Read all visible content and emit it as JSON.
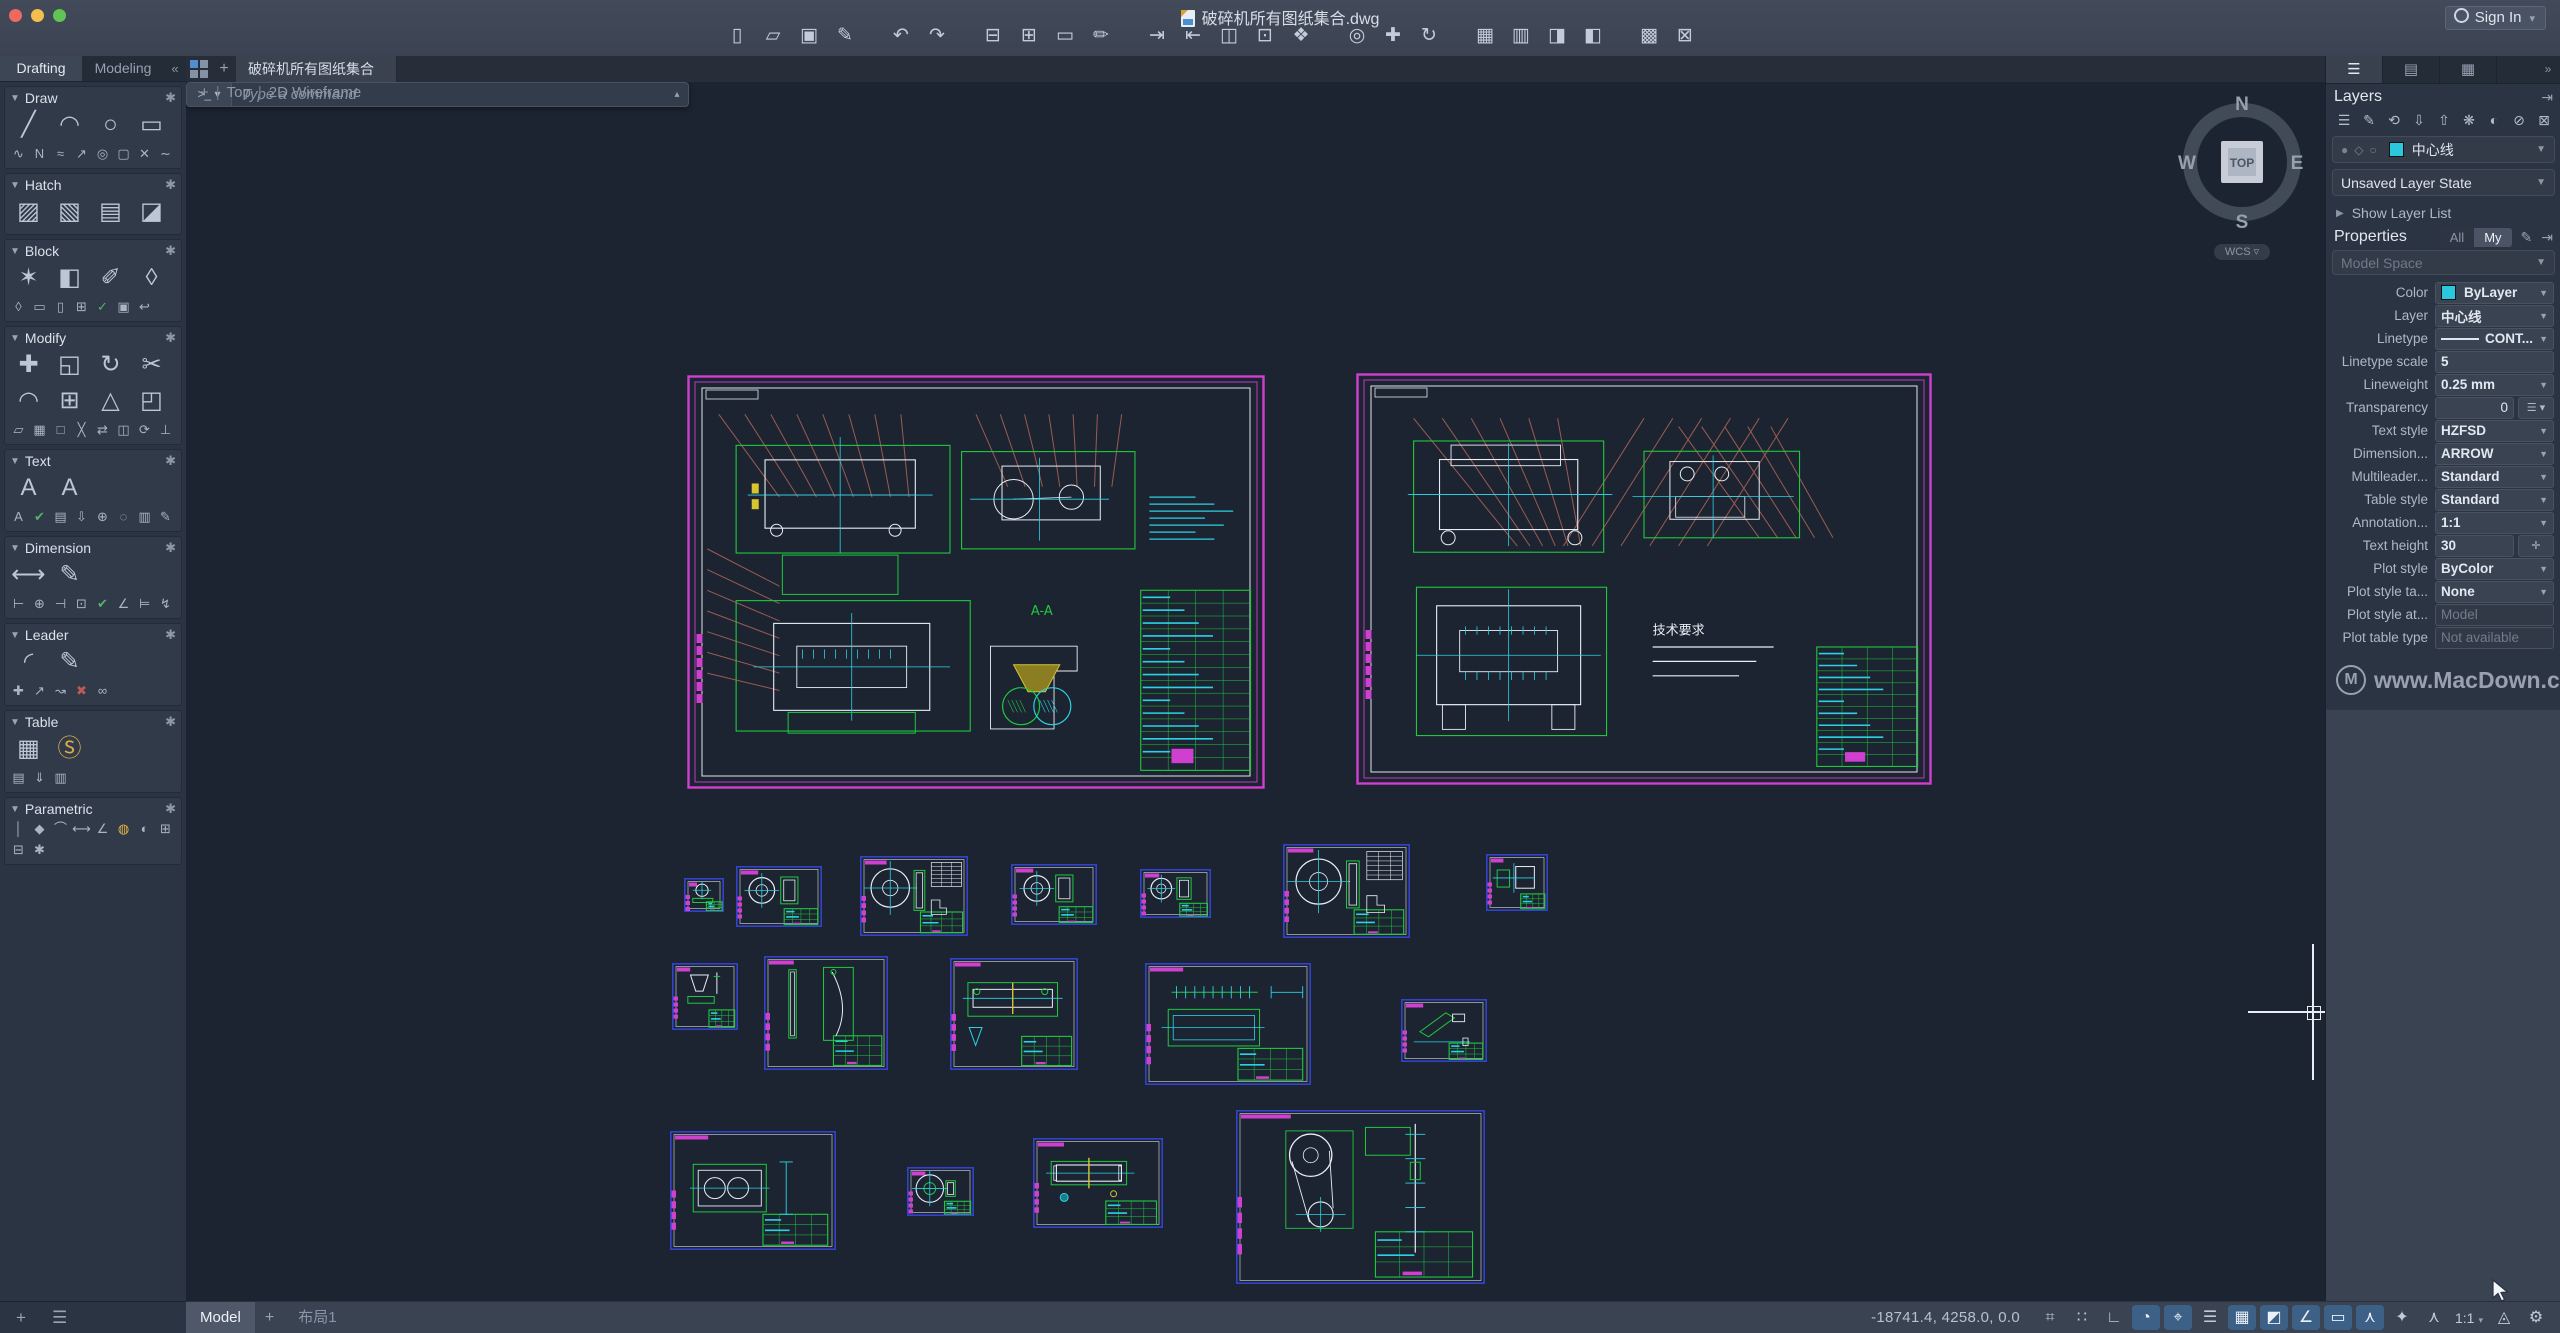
{
  "titlebar": {
    "title": "破碎机所有图纸集合.dwg",
    "sign_in": "Sign In",
    "toolbar_groups": [
      {
        "icons": [
          {
            "n": "new-file",
            "g": "▯"
          },
          {
            "n": "open-file",
            "g": "▱"
          },
          {
            "n": "save",
            "g": "▣"
          },
          {
            "n": "save-as",
            "g": "✎"
          }
        ]
      },
      {
        "icons": [
          {
            "n": "undo",
            "g": "↶"
          },
          {
            "n": "redo",
            "g": "↷"
          }
        ]
      },
      {
        "icons": [
          {
            "n": "print",
            "g": "⊟"
          },
          {
            "n": "batch-plot",
            "g": "⊞"
          },
          {
            "n": "page-setup",
            "g": "▭"
          },
          {
            "n": "plot-style",
            "g": "✏"
          }
        ]
      },
      {
        "icons": [
          {
            "n": "import",
            "g": "⇥"
          },
          {
            "n": "export",
            "g": "⇤"
          },
          {
            "n": "dwg-compare",
            "g": "◫"
          },
          {
            "n": "etransmit",
            "g": "⊡"
          },
          {
            "n": "reference",
            "g": "❖"
          }
        ]
      },
      {
        "icons": [
          {
            "n": "zoom",
            "g": "◎"
          },
          {
            "n": "pan",
            "g": "✚"
          },
          {
            "n": "orbit",
            "g": "↻"
          }
        ]
      },
      {
        "icons": [
          {
            "n": "tool-sets",
            "g": "▦"
          },
          {
            "n": "reference-manager",
            "g": "▥"
          },
          {
            "n": "design-center",
            "g": "◨"
          },
          {
            "n": "content-palette",
            "g": "◧"
          }
        ]
      },
      {
        "icons": [
          {
            "n": "layer-translator",
            "g": "▩"
          },
          {
            "n": "purge",
            "g": "⊠"
          }
        ]
      }
    ]
  },
  "left_palette": {
    "tabs": [
      {
        "label": "Drafting",
        "active": true
      },
      {
        "label": "Modeling",
        "active": false
      }
    ],
    "collapse": "«",
    "sections": [
      {
        "name": "Draw",
        "big": [
          {
            "n": "line",
            "g": "╱"
          },
          {
            "n": "arc",
            "g": "◠"
          },
          {
            "n": "circle",
            "g": "○"
          },
          {
            "n": "rectangle",
            "g": "▭"
          }
        ],
        "small": [
          {
            "n": "spline",
            "g": "∿"
          },
          {
            "n": "polyline",
            "g": "N"
          },
          {
            "n": "parallel",
            "g": "≈"
          },
          {
            "n": "ray",
            "g": "↗"
          },
          {
            "n": "ellipse",
            "g": "◎"
          },
          {
            "n": "polygon",
            "g": "▢"
          },
          {
            "n": "point",
            "g": "✕"
          },
          {
            "n": "revcloud",
            "g": "∼"
          }
        ]
      },
      {
        "name": "Hatch",
        "big": [
          {
            "n": "hatch",
            "g": "▨"
          },
          {
            "n": "hatch-edit",
            "g": "▧"
          },
          {
            "n": "gradient",
            "g": "▤"
          },
          {
            "n": "boundary",
            "g": "◪"
          }
        ],
        "small": []
      },
      {
        "name": "Block",
        "big": [
          {
            "n": "insert-block",
            "g": "✶"
          },
          {
            "n": "create-block",
            "g": "◧"
          },
          {
            "n": "edit-block",
            "g": "✐"
          },
          {
            "n": "define-attribute",
            "g": "◊"
          }
        ],
        "small": [
          {
            "n": "attribute-tag",
            "g": "◊"
          },
          {
            "n": "write-block",
            "g": "▭"
          },
          {
            "n": "save-block",
            "g": "▯"
          },
          {
            "n": "add-block",
            "g": "⊞"
          },
          {
            "n": "sync-attributes",
            "g": "✓"
          },
          {
            "n": "block-settings",
            "g": "▣"
          },
          {
            "n": "reset-block",
            "g": "↩"
          }
        ]
      },
      {
        "name": "Modify",
        "big": [
          {
            "n": "move",
            "g": "✚"
          },
          {
            "n": "copy",
            "g": "◱"
          },
          {
            "n": "rotate",
            "g": "↻"
          },
          {
            "n": "trim",
            "g": "✂"
          },
          {
            "n": "fillet",
            "g": "◠"
          },
          {
            "n": "array",
            "g": "⊞"
          },
          {
            "n": "mirror",
            "g": "△"
          },
          {
            "n": "stretch",
            "g": "◰"
          }
        ],
        "small": [
          {
            "n": "offset",
            "g": "▱"
          },
          {
            "n": "explode",
            "g": "▦"
          },
          {
            "n": "scale",
            "g": "□"
          },
          {
            "n": "break",
            "g": "╳"
          },
          {
            "n": "join",
            "g": "⇄"
          },
          {
            "n": "align",
            "g": "◫"
          },
          {
            "n": "update",
            "g": "⟳"
          },
          {
            "n": "erase",
            "g": "⊥"
          }
        ]
      },
      {
        "name": "Text",
        "big": [
          {
            "n": "multiline-text",
            "g": "A"
          },
          {
            "n": "edit-text",
            "g": "A"
          }
        ],
        "small": [
          {
            "n": "single-line-text",
            "g": "A"
          },
          {
            "n": "spell-check",
            "g": "✔"
          },
          {
            "n": "text-columns",
            "g": "▤"
          },
          {
            "n": "pdf-text",
            "g": "⇩"
          },
          {
            "n": "field",
            "g": "⊕"
          },
          {
            "n": "find-text",
            "g": "◌"
          },
          {
            "n": "text-style",
            "g": "▥"
          },
          {
            "n": "pdf-import",
            "g": "✎"
          }
        ]
      },
      {
        "name": "Dimension",
        "big": [
          {
            "n": "dimension",
            "g": "⟷"
          },
          {
            "n": "edit-dimension",
            "g": "✎"
          }
        ],
        "small": [
          {
            "n": "linear-dim",
            "g": "⊢"
          },
          {
            "n": "diameter-dim",
            "g": "⊕"
          },
          {
            "n": "baseline-dim",
            "g": "⊣"
          },
          {
            "n": "ordinate-dim",
            "g": "⊡"
          },
          {
            "n": "check-dim",
            "g": "✔"
          },
          {
            "n": "angular-dim",
            "g": "∠"
          },
          {
            "n": "continue-dim",
            "g": "⊨"
          },
          {
            "n": "jogged-dim",
            "g": "↯"
          }
        ]
      },
      {
        "name": "Leader",
        "big": [
          {
            "n": "multileader",
            "g": "◜"
          },
          {
            "n": "edit-leader",
            "g": "✎"
          }
        ],
        "small": [
          {
            "n": "add-leader",
            "g": "✚"
          },
          {
            "n": "align-leaders",
            "g": "↗"
          },
          {
            "n": "collect-leaders",
            "g": "↝"
          },
          {
            "n": "remove-leader",
            "g": "✖"
          },
          {
            "n": "merge-leaders",
            "g": "∞"
          }
        ]
      },
      {
        "name": "Table",
        "big": [
          {
            "n": "table",
            "g": "▦"
          },
          {
            "n": "data-link",
            "g": "Ⓢ"
          }
        ],
        "small": [
          {
            "n": "table-style",
            "g": "▤"
          },
          {
            "n": "export-table",
            "g": "⇓"
          },
          {
            "n": "update-table",
            "g": "▥"
          }
        ]
      },
      {
        "name": "Parametric",
        "big": [],
        "small": [
          {
            "n": "vertical-constraint",
            "g": "│"
          },
          {
            "n": "coincident-constraint",
            "g": "◆"
          },
          {
            "n": "tangent-constraint",
            "g": "⌒"
          },
          {
            "n": "dimensional-constraint",
            "g": "⟷"
          },
          {
            "n": "angle-constraint",
            "g": "∠"
          },
          {
            "n": "lock-constraint",
            "g": "◍"
          },
          {
            "n": "radius-constraint",
            "g": "◐"
          },
          {
            "n": "show-constraints",
            "g": "⊞"
          },
          {
            "n": "hide-constraints",
            "g": "⊟"
          },
          {
            "n": "constraint-settings",
            "g": "✱"
          }
        ]
      }
    ],
    "footer": [
      {
        "n": "add-view",
        "g": "+"
      },
      {
        "n": "view-list",
        "g": "☰"
      }
    ]
  },
  "doc_tabs": {
    "add": "+",
    "tabs": [
      {
        "label": "破碎机所有图纸集合",
        "active": true
      }
    ]
  },
  "viewport": {
    "add": "+",
    "view": "Top",
    "style": "2D Wireframe"
  },
  "compass": {
    "north": "N",
    "east": "E",
    "south": "S",
    "west": "W",
    "face": "TOP",
    "wcs": "WCS ▿"
  },
  "command": {
    "prompt": ">_ ▾",
    "placeholder": "Type a command",
    "expand": "▴"
  },
  "sidebar": {
    "tabs": [
      {
        "n": "tab-layers",
        "g": "☰",
        "active": true
      },
      {
        "n": "tab-references",
        "g": "▤",
        "active": false
      },
      {
        "n": "tab-sheets",
        "g": "▦",
        "active": false
      }
    ],
    "more": "»",
    "layers": {
      "title": "Layers",
      "autohide": "⇥",
      "tools": [
        {
          "n": "new-layer",
          "g": "☰"
        },
        {
          "n": "edit-layer",
          "g": "✎"
        },
        {
          "n": "layer-previous",
          "g": "⟲"
        },
        {
          "n": "isolate-layer",
          "g": "⇩"
        },
        {
          "n": "unisolate-layer",
          "g": "⇧"
        },
        {
          "n": "freeze-layer",
          "g": "❋"
        },
        {
          "n": "layer-off",
          "g": "◐"
        },
        {
          "n": "lock-layer",
          "g": "⊘"
        },
        {
          "n": "unlock-layer",
          "g": "⊠"
        }
      ],
      "current_layer": "中心线",
      "current_color": "#2bc7dc",
      "state": "Unsaved Layer State",
      "show_list": "Show Layer List"
    },
    "properties": {
      "title": "Properties",
      "filter_all": "All",
      "filter_my": "My",
      "edit_icon": "✎",
      "autohide": "⇥",
      "space": "Model Space",
      "rows": [
        {
          "label": "Color",
          "value": "ByLayer",
          "type": "color",
          "swatch": "#2bc7dc"
        },
        {
          "label": "Layer",
          "value": "中心线",
          "type": "select"
        },
        {
          "label": "Linetype",
          "value": "CONT...",
          "type": "linetype"
        },
        {
          "label": "Linetype scale",
          "value": "5",
          "type": "input"
        },
        {
          "label": "Lineweight",
          "value": "0.25 mm",
          "type": "select"
        },
        {
          "label": "Transparency",
          "value": "0",
          "type": "transparency"
        },
        {
          "label": "Text style",
          "value": "HZFSD",
          "type": "select"
        },
        {
          "label": "Dimension...",
          "value": "ARROW",
          "type": "select"
        },
        {
          "label": "Multileader...",
          "value": "Standard",
          "type": "select"
        },
        {
          "label": "Table style",
          "value": "Standard",
          "type": "select"
        },
        {
          "label": "Annotation...",
          "value": "1:1",
          "type": "select"
        },
        {
          "label": "Text height",
          "value": "30",
          "type": "textheight"
        },
        {
          "label": "Plot style",
          "value": "ByColor",
          "type": "select"
        },
        {
          "label": "Plot style ta...",
          "value": "None",
          "type": "select"
        },
        {
          "label": "Plot style at...",
          "value": "Model",
          "type": "readonly"
        },
        {
          "label": "Plot table type",
          "value": "Not available",
          "type": "readonly"
        }
      ]
    },
    "watermark": {
      "badge": "M",
      "text": "www.MacDown.com"
    }
  },
  "statusbar": {
    "model_tab": "Model",
    "add": "+",
    "layout_tab": "布局1",
    "coords": "-18741.4, 4258.0, 0.0",
    "icons": [
      {
        "n": "grid-mode",
        "g": "⌗",
        "on": false
      },
      {
        "n": "snap-mode",
        "g": "∷",
        "on": false
      },
      {
        "n": "ortho-mode",
        "g": "∟",
        "on": false
      },
      {
        "n": "polar-tracking",
        "g": "◔",
        "on": true
      },
      {
        "n": "dynamic-input",
        "g": "⌖",
        "on": true
      },
      {
        "n": "lineweight-display",
        "g": "☰",
        "on": false
      },
      {
        "n": "transparency-toggle",
        "g": "▦",
        "on": true
      },
      {
        "n": "selection-cycling",
        "g": "◩",
        "on": true
      },
      {
        "n": "object-snap",
        "g": "∠",
        "on": true
      },
      {
        "n": "snap-tracking",
        "g": "▭",
        "on": true
      },
      {
        "n": "object-snap-3d",
        "g": "⋏",
        "on": true
      },
      {
        "n": "auto-snap",
        "g": "✦",
        "on": false
      },
      {
        "n": "annotation-auto-scale",
        "g": "⋏",
        "on": false
      }
    ],
    "scale": "1:1",
    "caret": "▾",
    "tail_icons": [
      {
        "n": "annotation-visibility",
        "g": "◬"
      },
      {
        "n": "settings-gear",
        "g": "⚙"
      }
    ]
  },
  "sheets": {
    "large": [
      {
        "x": 687,
        "y": 375,
        "w": 578,
        "h": 414,
        "variant": "a",
        "section_label": "A-A"
      },
      {
        "x": 1356,
        "y": 373,
        "w": 576,
        "h": 412,
        "variant": "b",
        "notes_title": "技术要求"
      }
    ],
    "small": [
      {
        "x": 684,
        "y": 878,
        "w": 40,
        "h": 34,
        "variant": "tinywheel"
      },
      {
        "x": 736,
        "y": 866,
        "w": 86,
        "h": 61,
        "variant": "wheel"
      },
      {
        "x": 860,
        "y": 856,
        "w": 108,
        "h": 80,
        "variant": "bigwheel"
      },
      {
        "x": 1011,
        "y": 864,
        "w": 86,
        "h": 61,
        "variant": "wheel"
      },
      {
        "x": 1140,
        "y": 869,
        "w": 71,
        "h": 49,
        "variant": "wheel"
      },
      {
        "x": 1283,
        "y": 844,
        "w": 127,
        "h": 94,
        "variant": "bigwheel"
      },
      {
        "x": 1486,
        "y": 854,
        "w": 62,
        "h": 57,
        "variant": "bracket"
      },
      {
        "x": 672,
        "y": 963,
        "w": 66,
        "h": 67,
        "variant": "funnel"
      },
      {
        "x": 764,
        "y": 956,
        "w": 124,
        "h": 114,
        "variant": "slats"
      },
      {
        "x": 950,
        "y": 958,
        "w": 128,
        "h": 112,
        "variant": "hshaft"
      },
      {
        "x": 1145,
        "y": 963,
        "w": 166,
        "h": 122,
        "variant": "conveyor"
      },
      {
        "x": 1401,
        "y": 999,
        "w": 86,
        "h": 63,
        "variant": "link"
      },
      {
        "x": 670,
        "y": 1131,
        "w": 166,
        "h": 119,
        "variant": "plate2"
      },
      {
        "x": 907,
        "y": 1167,
        "w": 67,
        "h": 49,
        "variant": "hub"
      },
      {
        "x": 1033,
        "y": 1138,
        "w": 130,
        "h": 90,
        "variant": "roller"
      },
      {
        "x": 1236,
        "y": 1110,
        "w": 249,
        "h": 174,
        "variant": "beltdrive"
      }
    ]
  }
}
